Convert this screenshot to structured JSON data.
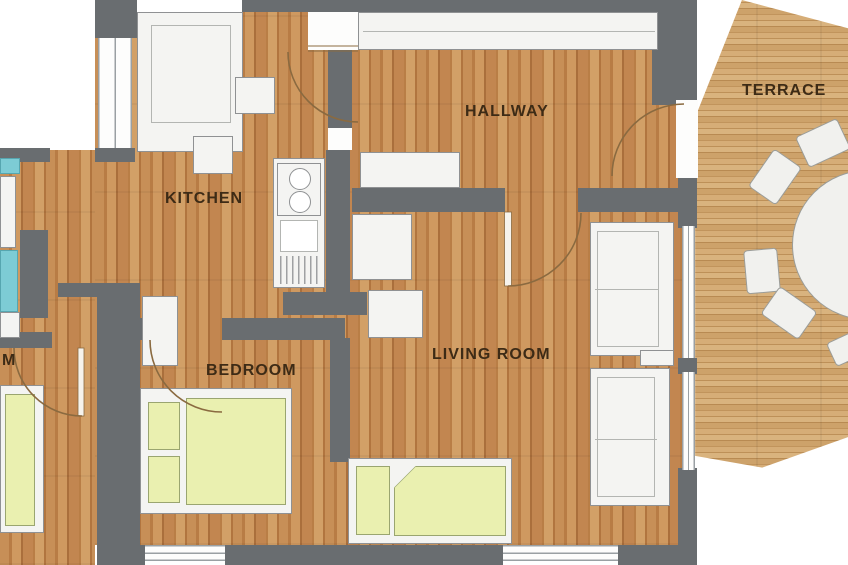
{
  "rooms": {
    "kitchen": {
      "label": "KITCHEN"
    },
    "hallway": {
      "label": "HALLWAY"
    },
    "terrace": {
      "label": "TERRACE"
    },
    "living_room": {
      "label": "LIVING ROOM"
    },
    "bedroom": {
      "label": "BEDROOM"
    },
    "partial_room": {
      "label": "M"
    }
  },
  "fixtures": {
    "kitchen": [
      "kitchen-cabinets",
      "stove",
      "sink",
      "counter"
    ],
    "hallway": [
      "closet",
      "bench"
    ],
    "living_room": [
      "sofa",
      "daybed",
      "cabinet"
    ],
    "bedroom": [
      "double-bed",
      "nightstand"
    ],
    "terrace": [
      "round-dining-table",
      "chairs"
    ],
    "bathroom_partial": [
      "bathtub",
      "washbasin"
    ],
    "partial_room": [
      "single-bed"
    ]
  },
  "colors": {
    "wall": "#696d70",
    "wood_floor": "#c28650",
    "terrace_floor": "#cda26a",
    "furniture": "#f4f4f2",
    "bed_linen": "#eaf0b0",
    "tub": "#7dccd5",
    "label_text": "#3d2b16",
    "background": "#ffffff"
  }
}
